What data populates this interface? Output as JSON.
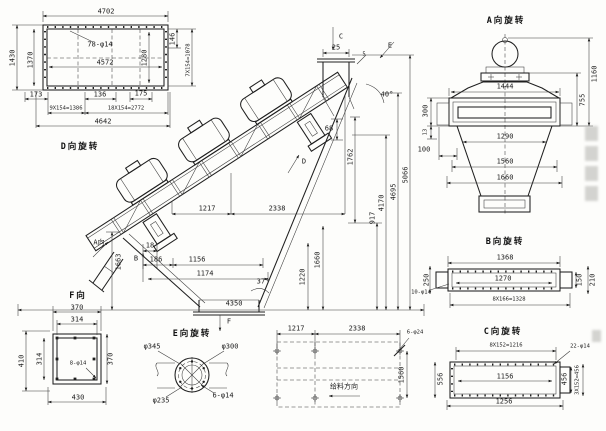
{
  "drawing": {
    "views": {
      "d": {
        "title": "D向旋转",
        "dims": {
          "top": "4702",
          "holes": "78-φ14",
          "inner": "4572",
          "left_outer": "1430",
          "left_inner": "1370",
          "right_inner": "1280",
          "right_small": "146",
          "right_pitch": "7X154=1078",
          "bottom_left": "173",
          "bottom_mid": "136",
          "bottom_right": "175",
          "bottom_pitch1": "9X154=1386",
          "bottom_pitch2": "18X154=2772",
          "bottom_total": "4642"
        }
      },
      "main": {
        "labels": {
          "a": "A向",
          "b": "B",
          "c": "C",
          "d": "D",
          "e": "E",
          "f": "F"
        },
        "dims": {
          "top_25": "25",
          "top_5": "5",
          "angle_40": "40°",
          "angle_37": "37°",
          "len_68": "68",
          "h_1762": "1762",
          "h_917": "917",
          "h_4170": "4170",
          "h_4695": "4695",
          "h_5066": "5066",
          "span_1217": "1217",
          "span_2338": "2338",
          "left_1663": "1663",
          "d_18": "18",
          "d_186": "186",
          "d_1156": "1156",
          "d_1174": "1174",
          "h_1220": "1220",
          "h_1660": "1660",
          "base_4350": "4350"
        }
      },
      "e": {
        "title": "E向旋转",
        "dims": {
          "outer": "φ345",
          "bolt_circle": "φ300",
          "inner": "φ235",
          "holes": "6-φ14"
        }
      },
      "f": {
        "title": "F向",
        "dims": {
          "top": "370",
          "top_inner": "314",
          "left": "410",
          "left_inner": "314",
          "right": "370",
          "bottom": "430",
          "holes": "8-φ14"
        }
      },
      "base": {
        "dims": {
          "x1": "1217",
          "x2": "2338",
          "holes": "6-φ24",
          "depth": "1560"
        },
        "feed_direction": "给料方向"
      },
      "a": {
        "title": "A向旋转",
        "dims": {
          "top": "1444",
          "height": "1160",
          "height2": "755",
          "left1": "300",
          "left2": "13",
          "left3": "100",
          "w1": "1290",
          "w2": "1560",
          "w3": "1660"
        }
      },
      "b": {
        "title": "B向旋转",
        "dims": {
          "top": "1368",
          "inner": "1270",
          "left": "250",
          "right1": "150",
          "right2": "210",
          "holes": "10-φ14",
          "pitch": "8X166=1328"
        }
      },
      "c": {
        "title": "C向旋转",
        "dims": {
          "pitch": "8X152=1216",
          "holes": "22-φ14",
          "inner": "1156",
          "bottom": "1256",
          "left": "556",
          "right1": "456",
          "right2": "3X152=456"
        }
      }
    }
  }
}
